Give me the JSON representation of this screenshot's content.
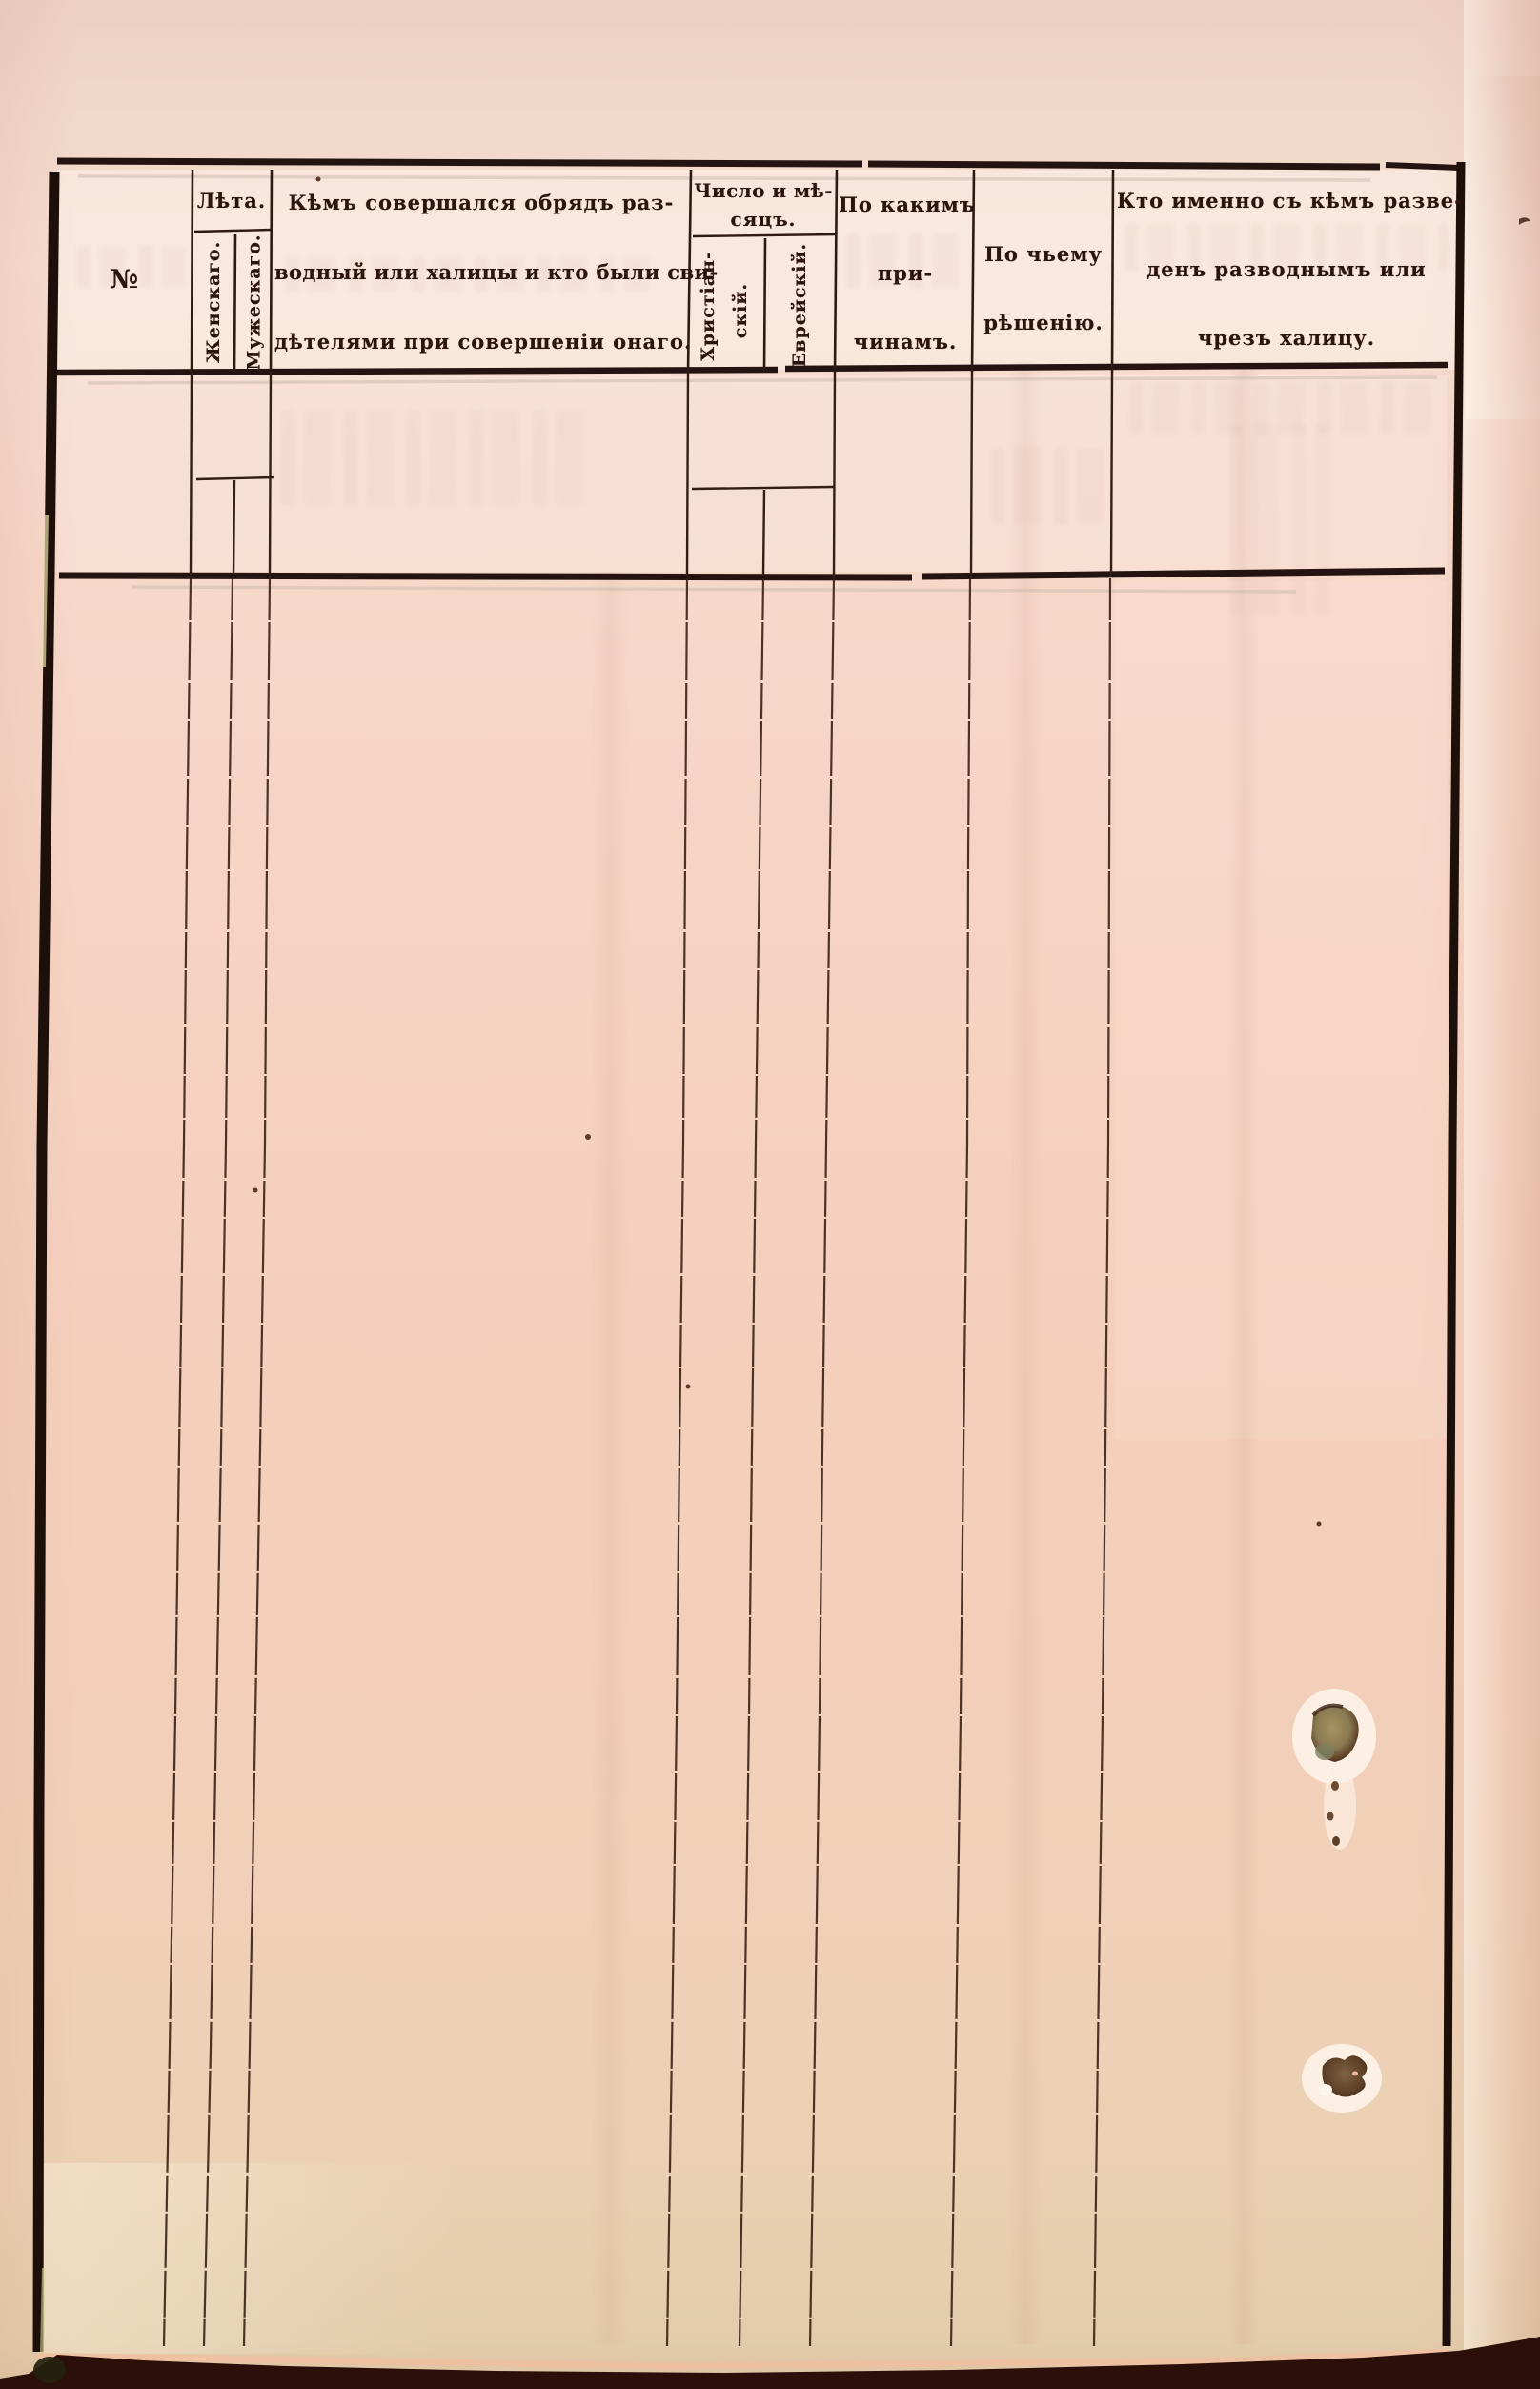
{
  "table": {
    "columns": [
      {
        "id": "number",
        "label": "№"
      },
      {
        "id": "age",
        "label": "Лѣта.",
        "sub": [
          {
            "label": "Женскаго."
          },
          {
            "label": "Мужескаго."
          }
        ]
      },
      {
        "id": "ceremony",
        "lines": [
          "Кѣмъ совершался обрядъ раз-",
          "водный или халицы и кто были сви-",
          "дѣтелями при совершеніи онаго."
        ]
      },
      {
        "id": "date",
        "lines": [
          "Число и мѣ-",
          "сяцъ."
        ],
        "sub": [
          {
            "lines": [
              "Христіан-",
              "скій."
            ]
          },
          {
            "lines": [
              "Еврейскій."
            ]
          }
        ]
      },
      {
        "id": "reasons",
        "lines": [
          "По какимъ",
          "при-",
          "чинамъ."
        ]
      },
      {
        "id": "decision",
        "lines": [
          "По чьему",
          "рѣшенію."
        ]
      },
      {
        "id": "who",
        "lines": [
          "Кто именно съ кѣмъ разве-",
          "денъ разводнымъ или",
          "чрезъ халицу."
        ]
      }
    ],
    "rows": []
  },
  "colors": {
    "paper": "#f5d3c2",
    "paper_light": "#f7e0d4",
    "paper_bottom": "#e5cdac",
    "ink": "#241310",
    "thin_rule": "#3a2115",
    "bottom_edge": "#2d0f09",
    "hole_fill": "#907a52"
  }
}
